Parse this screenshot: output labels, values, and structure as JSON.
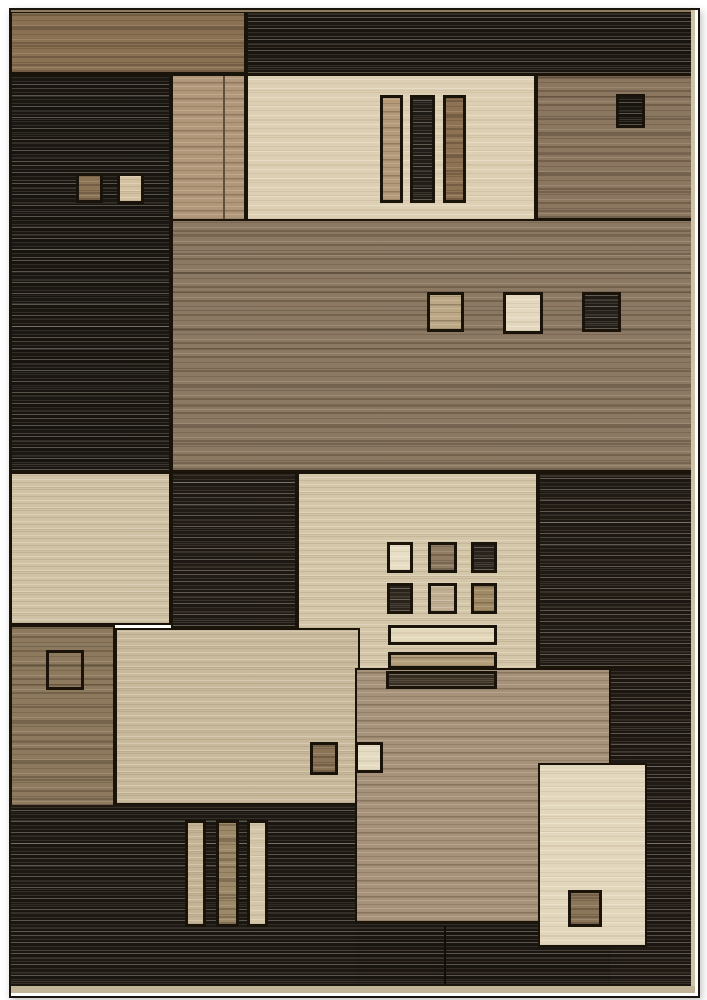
{
  "image_type": "product-photo-of-geometric-area-rug",
  "canvas": {
    "width": 707,
    "height": 1000,
    "background": "#ffffff"
  },
  "rug": {
    "x": 9,
    "y": 8,
    "width": 687,
    "height": 986,
    "frame_color": "#1a140e"
  },
  "palette": {
    "dark_charcoal": "#231d17",
    "brown": "#8b7660",
    "tan": "#b1977a",
    "beige": "#d0c2a5",
    "cream": "#ddcfb3",
    "edge_binding_light": "#c2b496",
    "edge_binding_top": "#8f7c5e",
    "outline": "#191309"
  },
  "blocks": [
    {
      "name": "top-left-brown-band",
      "x": 10,
      "y": 11,
      "w": 236,
      "h": 63,
      "tone": "brown",
      "color": "#8a7154",
      "border": true
    },
    {
      "name": "top-right-dark-band",
      "x": 246,
      "y": 11,
      "w": 449,
      "h": 64,
      "tone": "dark",
      "color": "#231d17",
      "border": true
    },
    {
      "name": "left-dark-column",
      "x": 10,
      "y": 74,
      "w": 161,
      "h": 398,
      "tone": "dark",
      "color": "#211c17",
      "border": true
    },
    {
      "name": "upper-tan-column",
      "x": 171,
      "y": 74,
      "w": 75,
      "h": 147,
      "tone": "tan",
      "color": "#b1977a",
      "border": true
    },
    {
      "name": "tan-column-divider",
      "x": 223,
      "y": 76,
      "w": 2,
      "h": 143,
      "tone": "flat",
      "color": "#5f4e3b",
      "border": false
    },
    {
      "name": "upper-cream-panel",
      "x": 246,
      "y": 74,
      "w": 290,
      "h": 147,
      "tone": "cream",
      "color": "#ddcfb3",
      "border": true
    },
    {
      "name": "upper-right-brown-block",
      "x": 536,
      "y": 74,
      "w": 159,
      "h": 146,
      "tone": "brown",
      "color": "#8b7660",
      "border": true
    },
    {
      "name": "middle-brown-band",
      "x": 171,
      "y": 219,
      "w": 524,
      "h": 253,
      "tone": "brown",
      "color": "#8c7963",
      "border": true
    },
    {
      "name": "left-beige-block",
      "x": 10,
      "y": 472,
      "w": 161,
      "h": 153,
      "tone": "beige",
      "color": "#d0c2a5",
      "border": true
    },
    {
      "name": "middle-dark-left-block",
      "x": 171,
      "y": 472,
      "w": 126,
      "h": 156,
      "tone": "dark",
      "color": "#29221b",
      "border": true
    },
    {
      "name": "central-beige-panel",
      "x": 297,
      "y": 472,
      "w": 241,
      "h": 200,
      "tone": "beige",
      "color": "#d4c6a9",
      "border": true
    },
    {
      "name": "middle-dark-right-block",
      "x": 538,
      "y": 472,
      "w": 157,
      "h": 196,
      "tone": "dark",
      "color": "#28211a",
      "border": true
    },
    {
      "name": "lower-left-brown-column",
      "x": 10,
      "y": 625,
      "w": 105,
      "h": 183,
      "tone": "brown",
      "color": "#8d7a5e",
      "border": true
    },
    {
      "name": "lower-mid-beige-block",
      "x": 115,
      "y": 628,
      "w": 245,
      "h": 177,
      "tone": "beige",
      "color": "#c8b99c",
      "border": true
    },
    {
      "name": "bottom-left-dark-band",
      "x": 10,
      "y": 805,
      "w": 345,
      "h": 182,
      "tone": "dark",
      "color": "#241e18",
      "border": false
    },
    {
      "name": "lower-right-dark-column",
      "x": 611,
      "y": 668,
      "w": 84,
      "h": 319,
      "tone": "dark",
      "color": "#261f19",
      "border": false
    },
    {
      "name": "lower-tan-block",
      "x": 355,
      "y": 668,
      "w": 256,
      "h": 255,
      "tone": "tan",
      "color": "#a6927a",
      "border": true
    },
    {
      "name": "bottom-center-dark-band",
      "x": 355,
      "y": 923,
      "w": 256,
      "h": 64,
      "tone": "dark",
      "color": "#221c16",
      "border": false
    },
    {
      "name": "bottom-right-cream-block",
      "x": 538,
      "y": 763,
      "w": 109,
      "h": 184,
      "tone": "cream",
      "color": "#e2d6bd",
      "border": true
    },
    {
      "name": "small-square-brown-upper-left",
      "x": 76,
      "y": 173,
      "w": 27,
      "h": 30,
      "tone": "brown",
      "color": "#8c7457",
      "border": true
    },
    {
      "name": "small-square-beige-upper-left",
      "x": 117,
      "y": 173,
      "w": 27,
      "h": 31,
      "tone": "beige",
      "color": "#d2c2a2",
      "border": true
    },
    {
      "name": "cream-panel-bar-tan",
      "x": 380,
      "y": 95,
      "w": 23,
      "h": 108,
      "tone": "tan",
      "color": "#b49a78",
      "border": true
    },
    {
      "name": "cream-panel-bar-dark",
      "x": 410,
      "y": 95,
      "w": 25,
      "h": 108,
      "tone": "dark",
      "color": "#2b251e",
      "border": true
    },
    {
      "name": "cream-panel-bar-brown",
      "x": 443,
      "y": 95,
      "w": 23,
      "h": 108,
      "tone": "brown",
      "color": "#8d7253",
      "border": true
    },
    {
      "name": "small-square-dark-upper-right",
      "x": 616,
      "y": 94,
      "w": 29,
      "h": 34,
      "tone": "dark",
      "color": "#211c16",
      "border": true
    },
    {
      "name": "band-square-tan",
      "x": 427,
      "y": 292,
      "w": 37,
      "h": 40,
      "tone": "tan",
      "color": "#bca886",
      "border": true
    },
    {
      "name": "band-square-cream",
      "x": 503,
      "y": 292,
      "w": 40,
      "h": 42,
      "tone": "cream",
      "color": "#e3d8bf",
      "border": true
    },
    {
      "name": "band-square-dark",
      "x": 582,
      "y": 292,
      "w": 39,
      "h": 40,
      "tone": "dark",
      "color": "#2d2721",
      "border": true
    },
    {
      "name": "grid-square-cream",
      "x": 387,
      "y": 542,
      "w": 26,
      "h": 31,
      "tone": "cream",
      "color": "#e8ddc5",
      "border": true
    },
    {
      "name": "grid-square-brown",
      "x": 428,
      "y": 542,
      "w": 29,
      "h": 31,
      "tone": "brown",
      "color": "#8f7c63",
      "border": true
    },
    {
      "name": "grid-square-dark",
      "x": 471,
      "y": 542,
      "w": 26,
      "h": 31,
      "tone": "dark",
      "color": "#332c25",
      "border": true
    },
    {
      "name": "grid-square-darkbrown",
      "x": 387,
      "y": 583,
      "w": 26,
      "h": 31,
      "tone": "dark",
      "color": "#393127",
      "border": true
    },
    {
      "name": "grid-square-beige",
      "x": 428,
      "y": 583,
      "w": 29,
      "h": 31,
      "tone": "beige",
      "color": "#bfae92",
      "border": true
    },
    {
      "name": "grid-square-tan",
      "x": 471,
      "y": 583,
      "w": 26,
      "h": 31,
      "tone": "tan",
      "color": "#a08a66",
      "border": true
    },
    {
      "name": "central-bar-cream",
      "x": 388,
      "y": 625,
      "w": 109,
      "h": 20,
      "tone": "cream",
      "color": "#e4d8bc",
      "border": true
    },
    {
      "name": "central-bar-tan",
      "x": 388,
      "y": 652,
      "w": 109,
      "h": 17,
      "tone": "tan",
      "color": "#b39d7b",
      "border": true
    },
    {
      "name": "central-bar-dark",
      "x": 386,
      "y": 671,
      "w": 111,
      "h": 18,
      "tone": "dark",
      "color": "#4a3e2f",
      "border": true
    },
    {
      "name": "outline-square-brown-column",
      "x": 46,
      "y": 650,
      "w": 38,
      "h": 40,
      "tone": "flat",
      "color": "none",
      "border": true
    },
    {
      "name": "small-square-brown-mid",
      "x": 310,
      "y": 742,
      "w": 28,
      "h": 33,
      "tone": "brown",
      "color": "#8a7356",
      "border": true
    },
    {
      "name": "small-square-cream-mid",
      "x": 355,
      "y": 742,
      "w": 28,
      "h": 31,
      "tone": "cream",
      "color": "#e5dbc2",
      "border": true
    },
    {
      "name": "bottom-bar-beige",
      "x": 185,
      "y": 820,
      "w": 21,
      "h": 107,
      "tone": "beige",
      "color": "#c4b394",
      "border": true
    },
    {
      "name": "bottom-bar-brown",
      "x": 216,
      "y": 820,
      "w": 23,
      "h": 107,
      "tone": "brown",
      "color": "#9d8968",
      "border": true
    },
    {
      "name": "bottom-bar-cream",
      "x": 247,
      "y": 820,
      "w": 21,
      "h": 107,
      "tone": "cream",
      "color": "#d3c6a9",
      "border": true
    },
    {
      "name": "small-square-brown-bottom-right",
      "x": 568,
      "y": 890,
      "w": 34,
      "h": 37,
      "tone": "brown",
      "color": "#8c765a",
      "border": true
    },
    {
      "name": "bottom-dark-seam",
      "x": 444,
      "y": 926,
      "w": 2,
      "h": 58,
      "tone": "flat",
      "color": "#120d09",
      "border": false
    },
    {
      "name": "rug-top-edge",
      "x": 10,
      "y": 9,
      "w": 685,
      "h": 3,
      "tone": "flat",
      "color": "#8f7c5e",
      "border": false
    },
    {
      "name": "rug-right-edge",
      "x": 691,
      "y": 9,
      "w": 4,
      "h": 984,
      "tone": "flat",
      "color": "#cfc3a8",
      "border": false
    },
    {
      "name": "rug-bottom-edge",
      "x": 10,
      "y": 986,
      "w": 685,
      "h": 7,
      "tone": "flat",
      "color": "#c2b496",
      "border": false
    }
  ]
}
